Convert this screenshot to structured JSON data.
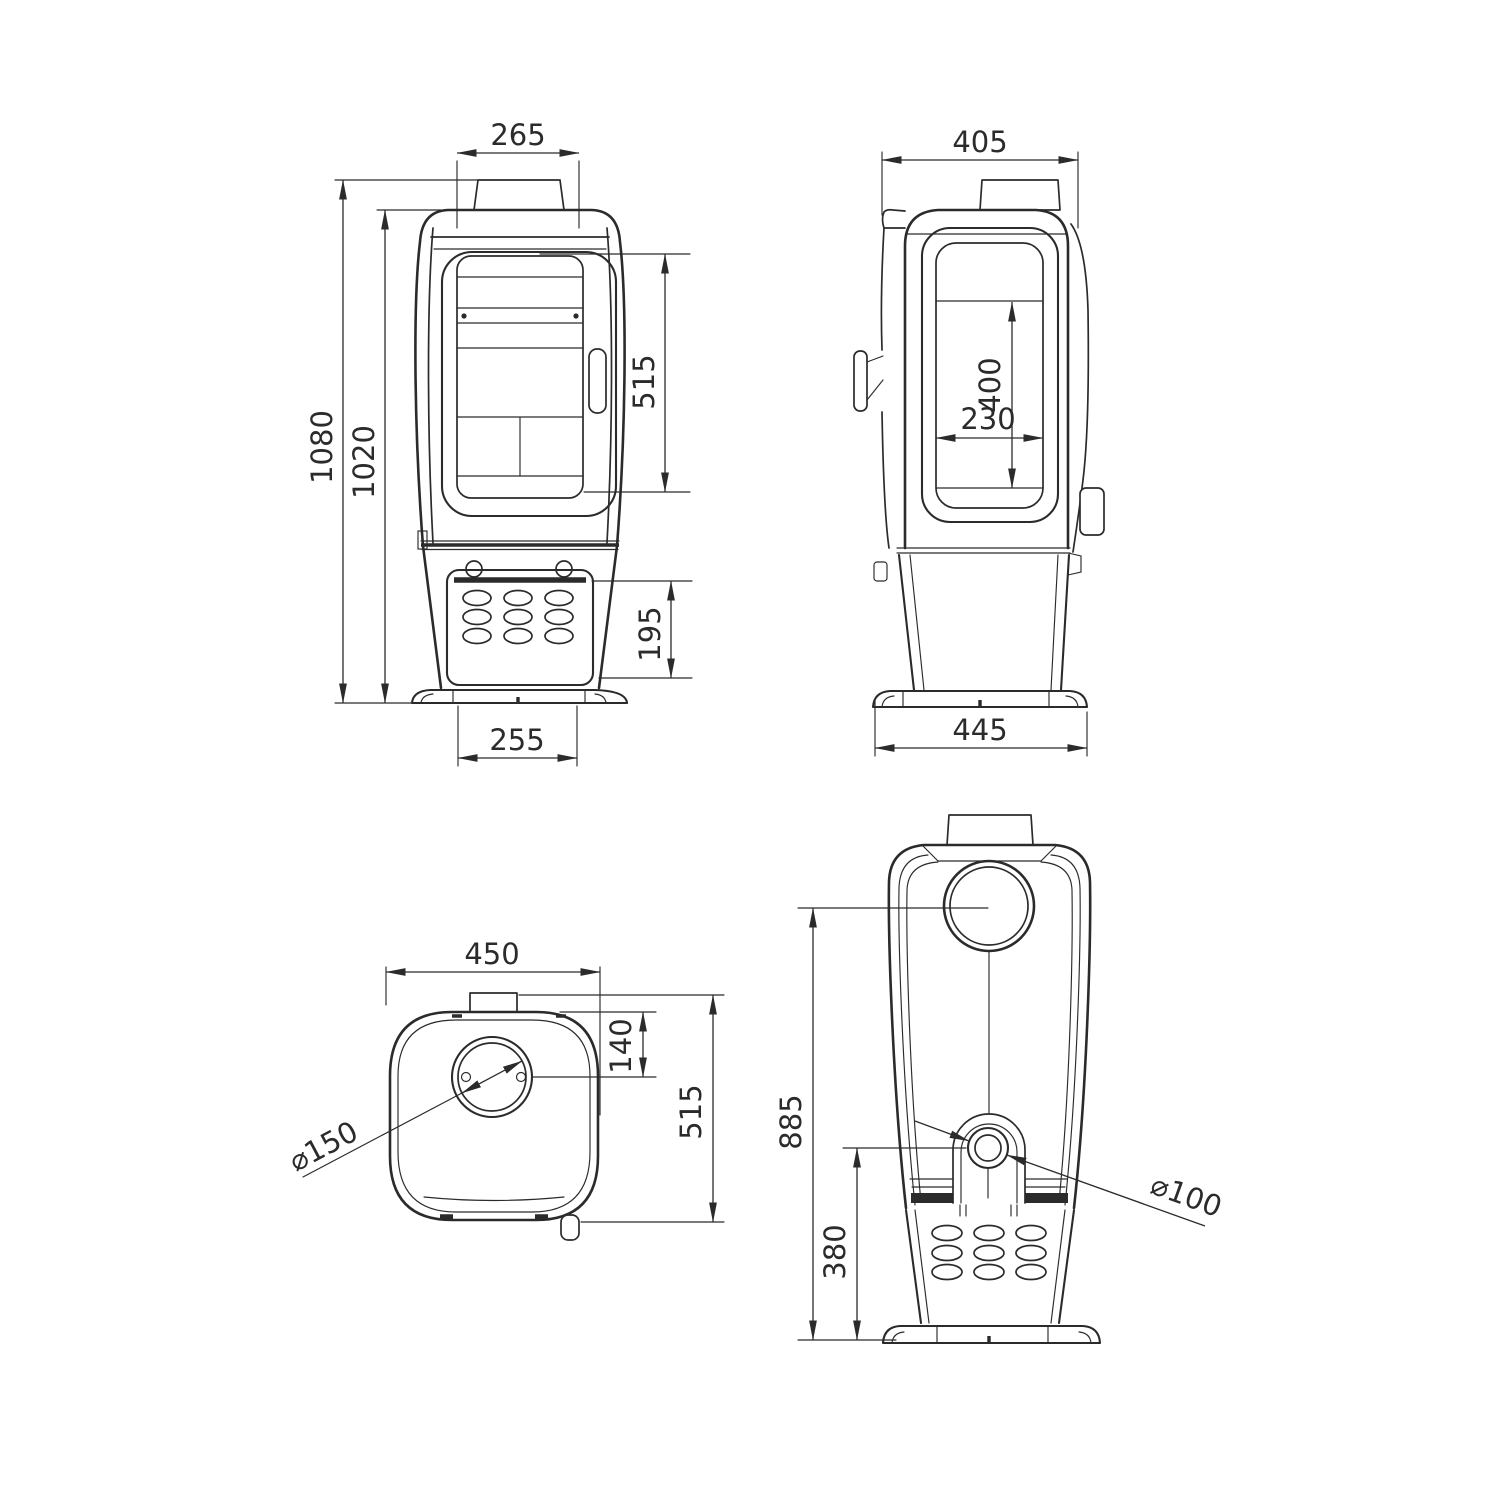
{
  "canvas": {
    "background": "#ffffff",
    "ink": "#2b2b2b"
  },
  "views": {
    "front": {
      "dims": {
        "flue_collar_width": "265",
        "overall_height": "1080",
        "body_height": "1020",
        "glass_door_height": "515",
        "ash_panel_height": "195",
        "base_width": "255"
      }
    },
    "side": {
      "dims": {
        "top_depth": "405",
        "side_window_height": "400",
        "side_window_width": "230",
        "base_depth": "445"
      }
    },
    "top": {
      "dims": {
        "overall_width": "450",
        "flue_centre_offset": "140",
        "overall_depth": "515",
        "flue_diameter": "⌀150"
      }
    },
    "rear": {
      "dims": {
        "flue_centre_height": "885",
        "outlet_centre_height": "380",
        "outlet_diameter": "⌀100"
      }
    }
  }
}
